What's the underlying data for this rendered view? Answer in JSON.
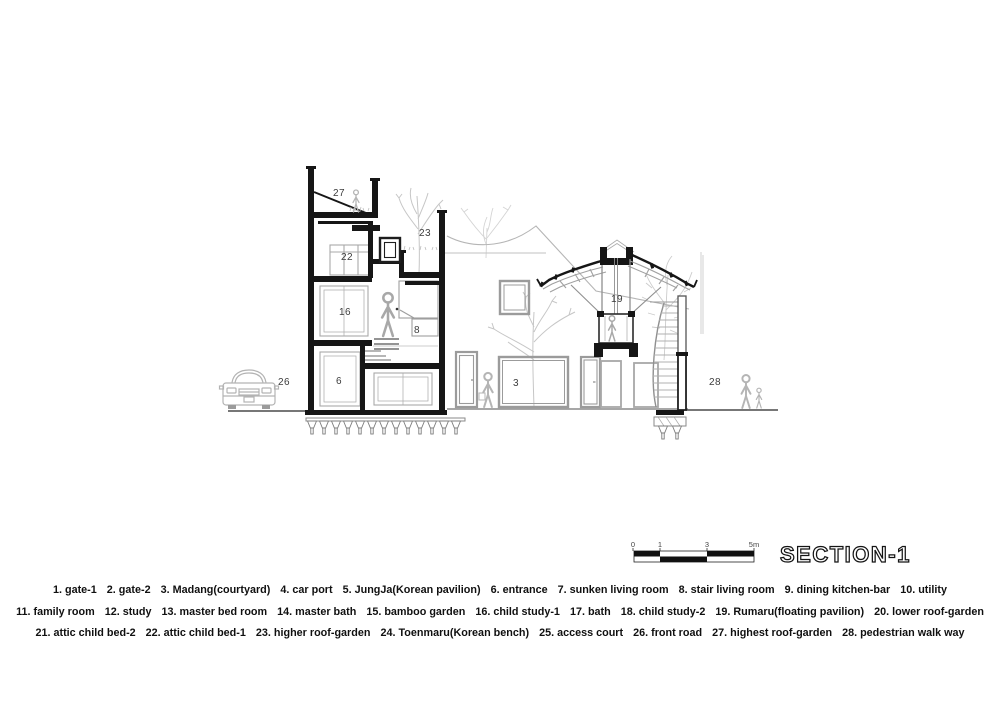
{
  "titles": {
    "section": "SECTION-1"
  },
  "scalebar": {
    "labels": [
      {
        "t": "0",
        "x": 633
      },
      {
        "t": "1",
        "x": 660
      },
      {
        "t": "3",
        "x": 707
      },
      {
        "t": "5m",
        "x": 754
      }
    ]
  },
  "drawing": {
    "labels": [
      {
        "t": "3",
        "x": 516,
        "y": 386
      },
      {
        "t": "6",
        "x": 339,
        "y": 384
      },
      {
        "t": "8",
        "x": 417,
        "y": 333
      },
      {
        "t": "16",
        "x": 345,
        "y": 315
      },
      {
        "t": "19",
        "x": 617,
        "y": 302
      },
      {
        "t": "22",
        "x": 347,
        "y": 260
      },
      {
        "t": "23",
        "x": 425,
        "y": 236
      },
      {
        "t": "26",
        "x": 284,
        "y": 385
      },
      {
        "t": "27",
        "x": 339,
        "y": 196
      },
      {
        "t": "28",
        "x": 715,
        "y": 385
      }
    ]
  },
  "legend": {
    "rows": [
      [
        {
          "n": "1",
          "label": "gate-1"
        },
        {
          "n": "2",
          "label": "gate-2"
        },
        {
          "n": "3",
          "label": "Madang(courtyard)"
        },
        {
          "n": "4",
          "label": "car port"
        },
        {
          "n": "5",
          "label": "JungJa(Korean pavilion)"
        },
        {
          "n": "6",
          "label": "entrance"
        },
        {
          "n": "7",
          "label": "sunken living room"
        },
        {
          "n": "8",
          "label": "stair living room"
        },
        {
          "n": "9",
          "label": "dining kitchen-bar"
        },
        {
          "n": "10",
          "label": "utility"
        }
      ],
      [
        {
          "n": "11",
          "label": "family room"
        },
        {
          "n": "12",
          "label": "study"
        },
        {
          "n": "13",
          "label": "master bed room"
        },
        {
          "n": "14",
          "label": "master bath"
        },
        {
          "n": "15",
          "label": "bamboo garden"
        },
        {
          "n": "16",
          "label": "child study-1"
        },
        {
          "n": "17",
          "label": "bath"
        },
        {
          "n": "18",
          "label": "child study-2"
        },
        {
          "n": "19",
          "label": "Rumaru(floating pavilion)"
        },
        {
          "n": "20",
          "label": "lower roof-garden"
        }
      ],
      [
        {
          "n": "21",
          "label": "attic child bed-2"
        },
        {
          "n": "22",
          "label": "attic child bed-1"
        },
        {
          "n": "23",
          "label": "higher roof-garden"
        },
        {
          "n": "24",
          "label": "Toenmaru(Korean bench)"
        },
        {
          "n": "25",
          "label": "access court"
        },
        {
          "n": "26",
          "label": "front road"
        },
        {
          "n": "27",
          "label": "highest roof-garden"
        },
        {
          "n": "28",
          "label": "pedestrian walk way"
        }
      ]
    ]
  },
  "colors": {
    "ink": "#161616",
    "mid_gray": "#8f8f8f",
    "light_gray": "#b9b9b9",
    "label": "#3c3c3c"
  }
}
